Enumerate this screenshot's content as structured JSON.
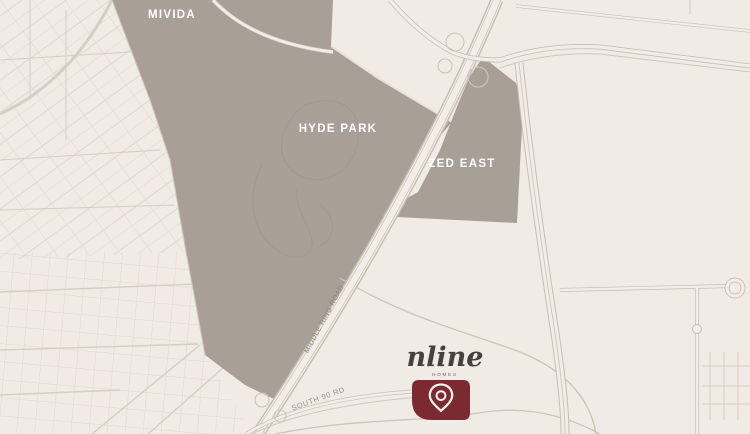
{
  "map": {
    "regions": [
      {
        "id": "mivida",
        "label": "MIVIDA"
      },
      {
        "id": "hyde-park",
        "label": "HYDE PARK"
      },
      {
        "id": "zed-east",
        "label": "ZED EAST"
      }
    ],
    "roads": [
      {
        "id": "middle-ring-road",
        "label": "MIDDLE RING ROAD"
      },
      {
        "id": "south-90-rd",
        "label": "SOUTH 90 RD"
      }
    ],
    "logo": {
      "name": "nline",
      "tagline": "HOMES"
    },
    "marker": {
      "name": "location-pin"
    },
    "colors": {
      "background": "#F0EBE4",
      "district_fill": "#A8A097",
      "district_label": "#FFFFFF",
      "road_fill": "#F2EEE7",
      "road_casing": "#C6BFB4",
      "road_label": "#8B8379",
      "logo_text": "#45423D",
      "marker_fill": "#7B2A31",
      "marker_glyph": "#F5F0E9"
    }
  }
}
